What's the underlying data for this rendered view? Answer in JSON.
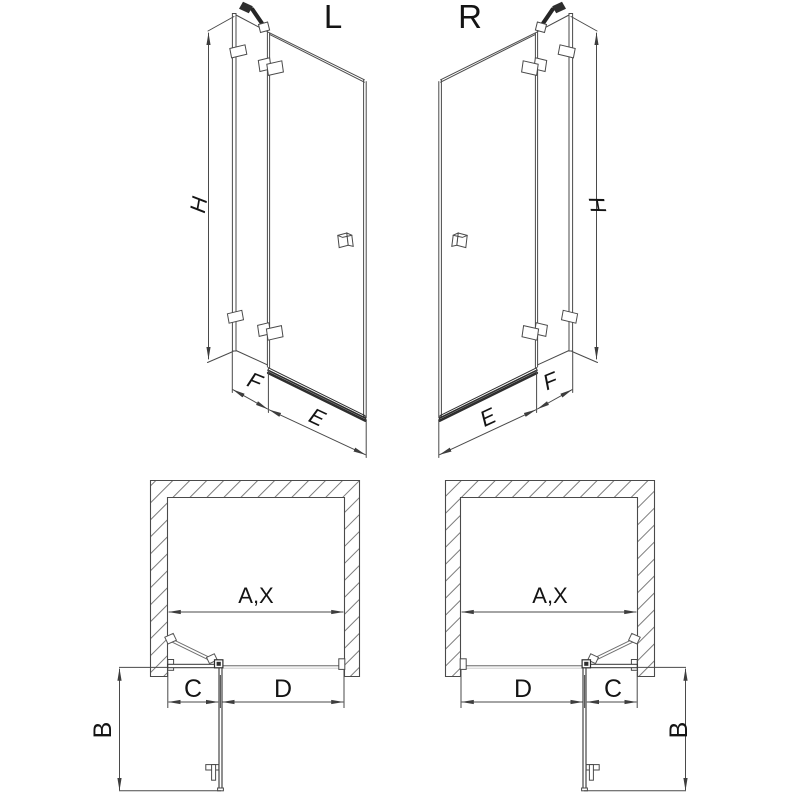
{
  "diagram": {
    "views": [
      {
        "id": "elevation-left",
        "variant": "L",
        "dimensions": [
          "H",
          "F",
          "E"
        ]
      },
      {
        "id": "elevation-right",
        "variant": "R",
        "dimensions": [
          "H",
          "E",
          "F"
        ]
      },
      {
        "id": "plan-left",
        "variant": "L",
        "dimensions": [
          "A,X",
          "C",
          "D",
          "B"
        ]
      },
      {
        "id": "plan-right",
        "variant": "R",
        "dimensions": [
          "A,X",
          "D",
          "C",
          "B"
        ]
      }
    ]
  },
  "labels": {
    "left_variant": "L",
    "right_variant": "R",
    "height": "H",
    "fixed_panel_width": "F",
    "door_width": "E",
    "opening_width": "A,X",
    "fixed_segment": "C",
    "door_segment": "D",
    "door_swing_depth": "B"
  },
  "colors": {
    "line": "#4a4a4a",
    "dark_line": "#262626",
    "light_line": "#9a9a9a",
    "text": "#141414",
    "background": "#ffffff"
  }
}
